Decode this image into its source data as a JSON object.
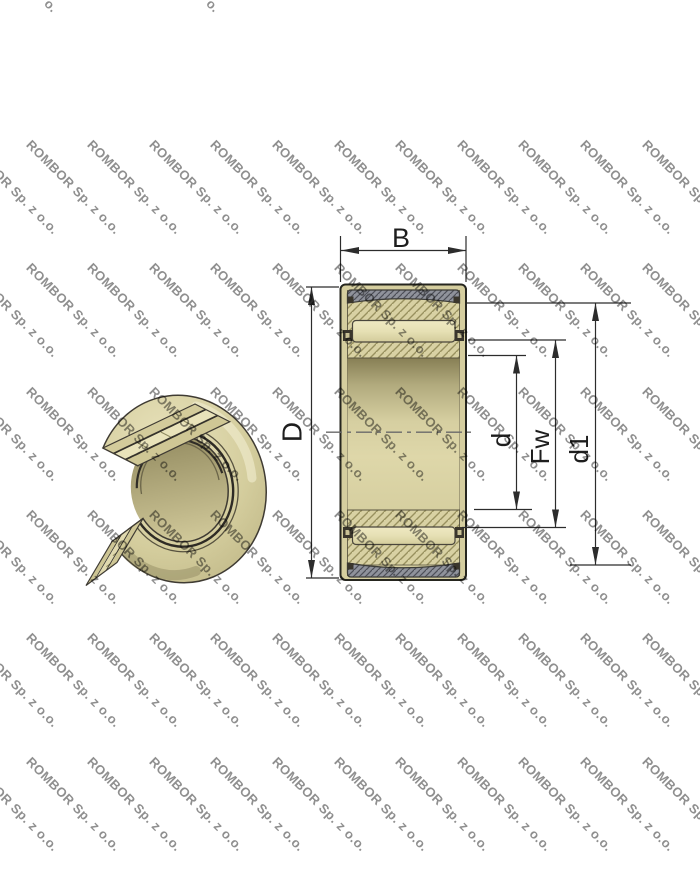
{
  "watermark": {
    "text": "ROMBOR Sp. z o.o.",
    "color": "#8f8f8f",
    "angle_deg": 45,
    "grid": {
      "x0": -28,
      "x_step": 61.6,
      "cols": 12,
      "y0": 137,
      "y_step": 123.3,
      "rows": 6
    },
    "top_fragments": [
      {
        "text": "o.",
        "x": 52,
        "y": -4
      },
      {
        "text": "o.",
        "x": 214,
        "y": -4
      }
    ]
  },
  "drawing": {
    "labels": {
      "width": "B",
      "outer_diameter": "D",
      "bore_diameter": "d",
      "needle_envelope": "Fw",
      "seat_diameter": "d1"
    },
    "colors": {
      "line": "#2b2b28",
      "khaki": "#d8d1a3",
      "khaki_hatch": "#98915f",
      "gray_band": "#8f929b",
      "gray_hatch": "#4d4f58",
      "roller": "#e9e3ba",
      "cage_dark": "#3a362c",
      "watermark_gray": "#8f8f8f"
    }
  }
}
